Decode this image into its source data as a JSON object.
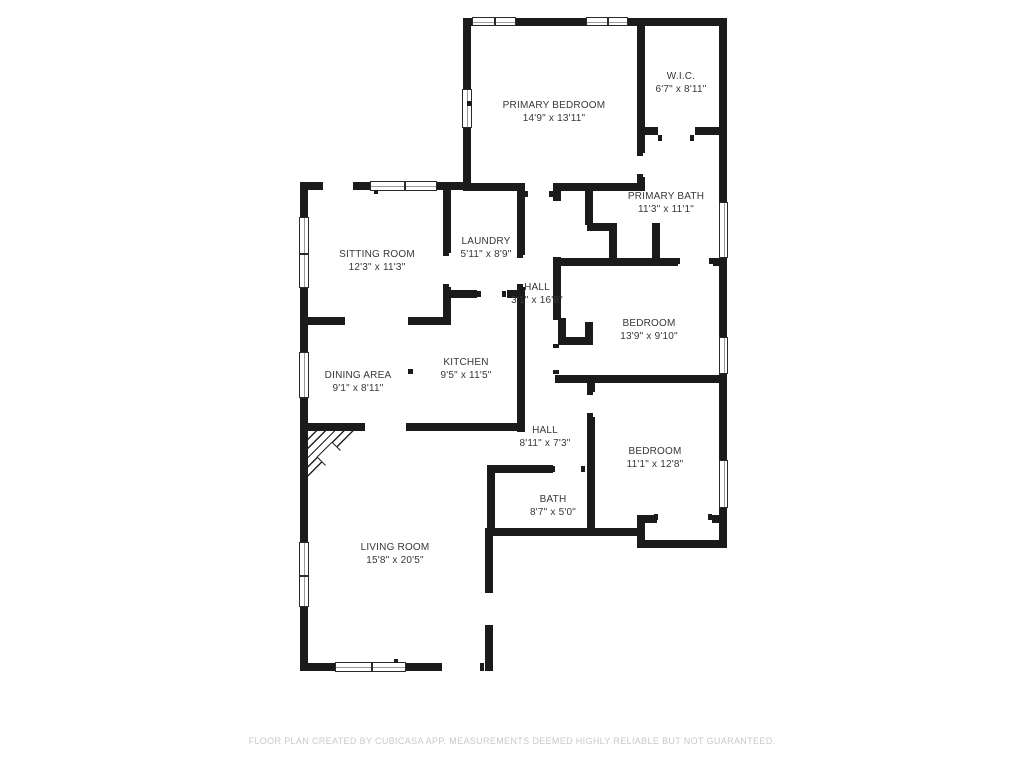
{
  "footer": "FLOOR PLAN CREATED BY CUBICASA APP. MEASUREMENTS DEEMED HIGHLY RELIABLE BUT NOT GUARANTEED.",
  "colors": {
    "wall": "#1b1b1b",
    "label": "#373737",
    "footer": "#c9c9c9",
    "background": "#ffffff"
  },
  "rooms": [
    {
      "name": "PRIMARY BEDROOM",
      "size": "14'9\" x 13'11\"",
      "x": 554,
      "y": 112
    },
    {
      "name": "W.I.C.",
      "size": "6'7\" x 8'11\"",
      "x": 681,
      "y": 83
    },
    {
      "name": "PRIMARY BATH",
      "size": "11'3\" x 11'1\"",
      "x": 666,
      "y": 203
    },
    {
      "name": "SITTING ROOM",
      "size": "12'3\" x 11'3\"",
      "x": 377,
      "y": 261
    },
    {
      "name": "LAUNDRY",
      "size": "5'11\" x 8'9\"",
      "x": 486,
      "y": 248
    },
    {
      "name": "HALL",
      "size": "3'1\" x 16'8\"",
      "x": 537,
      "y": 294
    },
    {
      "name": "BEDROOM",
      "size": "13'9\" x 9'10\"",
      "x": 649,
      "y": 330
    },
    {
      "name": "DINING AREA",
      "size": "9'1\" x 8'11\"",
      "x": 358,
      "y": 382
    },
    {
      "name": "KITCHEN",
      "size": "9'5\" x 11'5\"",
      "x": 466,
      "y": 369
    },
    {
      "name": "HALL",
      "size": "8'11\" x 7'3\"",
      "x": 545,
      "y": 437
    },
    {
      "name": "BEDROOM",
      "size": "11'1\" x 12'8\"",
      "x": 655,
      "y": 458
    },
    {
      "name": "BATH",
      "size": "8'7\" x 5'0\"",
      "x": 553,
      "y": 506
    },
    {
      "name": "LIVING ROOM",
      "size": "15'8\" x 20'5\"",
      "x": 395,
      "y": 554
    }
  ],
  "plan": {
    "walls": [
      [
        463,
        18,
        264,
        8
      ],
      [
        719,
        26,
        8,
        522
      ],
      [
        463,
        26,
        8,
        161
      ],
      [
        300,
        182,
        23,
        8
      ],
      [
        353,
        182,
        17,
        8
      ],
      [
        437,
        182,
        34,
        8
      ],
      [
        300,
        190,
        8,
        481
      ],
      [
        300,
        663,
        138,
        8
      ],
      [
        485,
        628,
        8,
        43
      ],
      [
        485,
        528,
        8,
        62
      ],
      [
        443,
        187,
        8,
        66
      ],
      [
        443,
        287,
        8,
        38
      ],
      [
        300,
        317,
        45,
        8
      ],
      [
        408,
        317,
        43,
        8
      ],
      [
        451,
        290,
        26,
        8
      ],
      [
        507,
        290,
        16,
        8
      ],
      [
        517,
        187,
        8,
        68
      ],
      [
        517,
        287,
        8,
        145
      ],
      [
        308,
        423,
        57,
        8
      ],
      [
        406,
        423,
        117,
        8
      ],
      [
        463,
        183,
        62,
        8
      ],
      [
        553,
        183,
        87,
        8
      ],
      [
        637,
        26,
        8,
        127
      ],
      [
        637,
        177,
        8,
        14
      ],
      [
        640,
        127,
        18,
        8
      ],
      [
        695,
        127,
        32,
        8
      ],
      [
        553,
        191,
        8,
        10
      ],
      [
        553,
        257,
        8,
        63
      ],
      [
        585,
        191,
        8,
        34
      ],
      [
        587,
        223,
        30,
        8
      ],
      [
        609,
        225,
        8,
        33
      ],
      [
        652,
        223,
        8,
        35
      ],
      [
        557,
        258,
        121,
        8
      ],
      [
        713,
        258,
        14,
        8
      ],
      [
        558,
        318,
        8,
        27
      ],
      [
        558,
        337,
        35,
        8
      ],
      [
        585,
        322,
        8,
        23
      ],
      [
        555,
        375,
        172,
        8
      ],
      [
        587,
        383,
        8,
        9
      ],
      [
        587,
        417,
        8,
        111
      ],
      [
        487,
        465,
        8,
        71
      ],
      [
        487,
        465,
        66,
        8
      ],
      [
        487,
        528,
        158,
        8
      ],
      [
        637,
        515,
        8,
        33
      ],
      [
        637,
        515,
        20,
        8
      ],
      [
        712,
        515,
        15,
        8
      ],
      [
        637,
        540,
        90,
        8
      ]
    ],
    "windows": [
      {
        "x": 472,
        "y": 17,
        "w": 44,
        "h": 9,
        "o": "h",
        "panes": 2
      },
      {
        "x": 586,
        "y": 17,
        "w": 42,
        "h": 9,
        "o": "h",
        "panes": 2
      },
      {
        "x": 462,
        "y": 89,
        "w": 10,
        "h": 39,
        "o": "v",
        "panes": 1
      },
      {
        "x": 370,
        "y": 181,
        "w": 67,
        "h": 10,
        "o": "h",
        "panes": 2
      },
      {
        "x": 299,
        "y": 217,
        "w": 10,
        "h": 71,
        "o": "v",
        "panes": 2
      },
      {
        "x": 299,
        "y": 352,
        "w": 10,
        "h": 46,
        "o": "v",
        "panes": 1
      },
      {
        "x": 299,
        "y": 542,
        "w": 10,
        "h": 65,
        "o": "v",
        "panes": 2
      },
      {
        "x": 335,
        "y": 662,
        "w": 71,
        "h": 10,
        "o": "h",
        "panes": 2
      },
      {
        "x": 719,
        "y": 202,
        "w": 9,
        "h": 56,
        "o": "v",
        "panes": 1
      },
      {
        "x": 719,
        "y": 337,
        "w": 9,
        "h": 37,
        "o": "v",
        "panes": 1
      },
      {
        "x": 719,
        "y": 460,
        "w": 9,
        "h": 48,
        "o": "v",
        "panes": 1
      }
    ],
    "door_ticks": [
      [
        374,
        190,
        4,
        4
      ],
      [
        524,
        191,
        4,
        6
      ],
      [
        549,
        191,
        4,
        6
      ],
      [
        658,
        135,
        4,
        6
      ],
      [
        690,
        135,
        4,
        6
      ],
      [
        637,
        152,
        6,
        4
      ],
      [
        637,
        174,
        6,
        4
      ],
      [
        467,
        101,
        5,
        5
      ],
      [
        443,
        252,
        6,
        4
      ],
      [
        443,
        284,
        6,
        4
      ],
      [
        517,
        254,
        6,
        4
      ],
      [
        517,
        284,
        6,
        4
      ],
      [
        477,
        291,
        4,
        6
      ],
      [
        502,
        291,
        4,
        6
      ],
      [
        676,
        258,
        4,
        6
      ],
      [
        709,
        258,
        4,
        6
      ],
      [
        553,
        344,
        6,
        4
      ],
      [
        553,
        370,
        6,
        4
      ],
      [
        587,
        391,
        6,
        4
      ],
      [
        587,
        413,
        6,
        4
      ],
      [
        551,
        466,
        4,
        6
      ],
      [
        581,
        466,
        4,
        6
      ],
      [
        438,
        663,
        4,
        8
      ],
      [
        480,
        663,
        4,
        8
      ],
      [
        485,
        589,
        8,
        4
      ],
      [
        485,
        625,
        8,
        4
      ],
      [
        408,
        369,
        5,
        5
      ],
      [
        394,
        659,
        4,
        4
      ],
      [
        654,
        514,
        4,
        6
      ],
      [
        708,
        514,
        4,
        6
      ]
    ],
    "fireplace": {
      "x": 307,
      "y": 430,
      "size": 54,
      "diamond": {
        "dx": 14,
        "dy": 16,
        "side": 20
      }
    }
  }
}
